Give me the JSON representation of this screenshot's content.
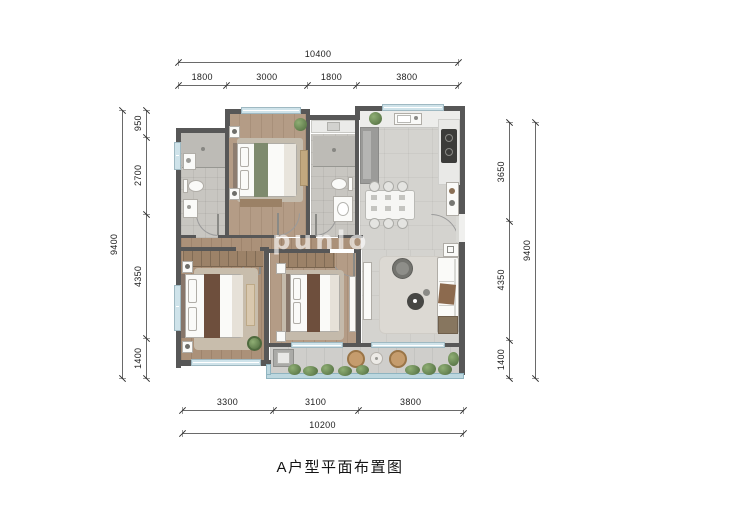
{
  "title": "A户型平面布置图",
  "watermark": "punlo",
  "dimensions": {
    "top": {
      "total": [
        "10400"
      ],
      "segments": [
        "1800",
        "3000",
        "1800",
        "3800"
      ]
    },
    "bottom": {
      "total": [
        "10200"
      ],
      "segments": [
        "3300",
        "3100",
        "3800"
      ]
    },
    "left": {
      "total": [
        "9400"
      ],
      "segments": [
        "950",
        "2700",
        "4350",
        "1400"
      ]
    },
    "right": {
      "total": [
        "9400"
      ],
      "segments": [
        "3650",
        "4350",
        "1400"
      ]
    }
  },
  "colors": {
    "wall": "#575757",
    "wood_floor": "#b09880",
    "tile_floor": "#d4d3cf",
    "bath_floor": "#c8c6c1",
    "window": "#cfe3ea",
    "balcony_railing": "#bcd7df",
    "plant_green": "#6c8a58",
    "bed_runner_brown": "#6e4f3d",
    "bed_runner_green": "#7e8a6e"
  }
}
